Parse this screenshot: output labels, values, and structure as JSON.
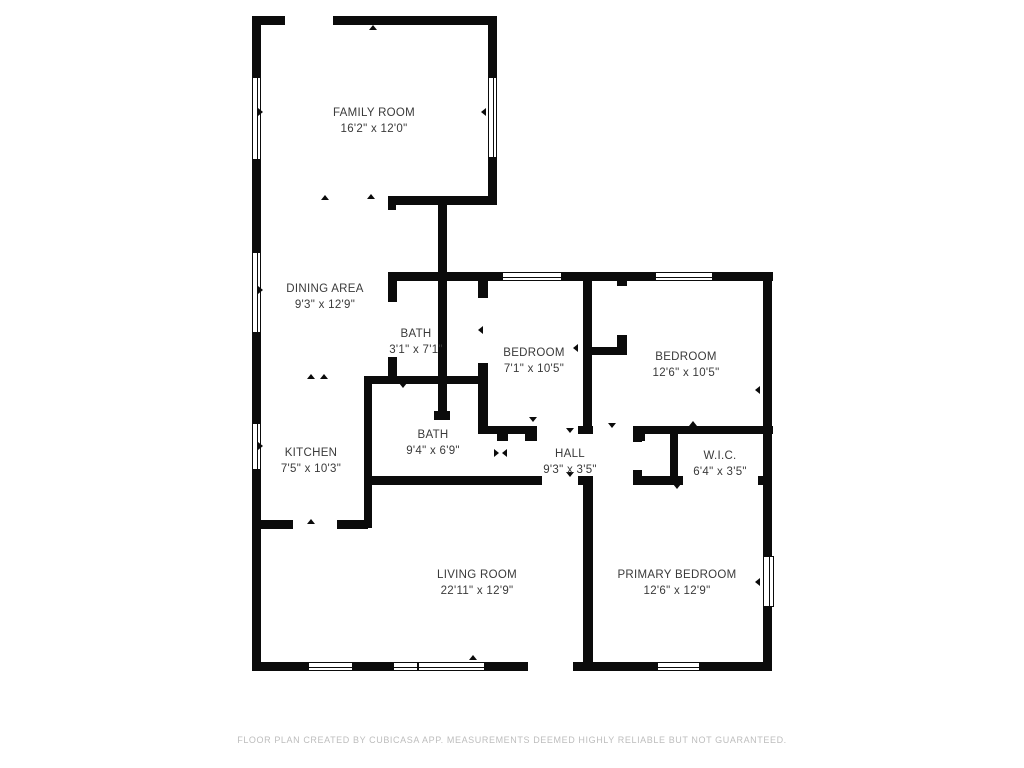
{
  "footer": {
    "text": "FLOOR PLAN CREATED BY CUBICASA APP. MEASUREMENTS DEEMED HIGHLY RELIABLE BUT NOT GUARANTEED."
  },
  "colors": {
    "wall": "#0b0b0b",
    "label": "#3a3a3a",
    "footer": "#bdbdbd",
    "background": "#ffffff"
  },
  "rooms": [
    {
      "name": "FAMILY ROOM",
      "dims": "16'2\" x 12'0\"",
      "cx": 374,
      "cy": 113
    },
    {
      "name": "DINING AREA",
      "dims": "9'3\" x 12'9\"",
      "cx": 325,
      "cy": 289
    },
    {
      "name": "BATH",
      "dims": "3'1\" x 7'1\"",
      "cx": 416,
      "cy": 334
    },
    {
      "name": "BEDROOM",
      "dims": "7'1\" x 10'5\"",
      "cx": 534,
      "cy": 353
    },
    {
      "name": "BEDROOM",
      "dims": "12'6\" x 10'5\"",
      "cx": 686,
      "cy": 357
    },
    {
      "name": "KITCHEN",
      "dims": "7'5\" x 10'3\"",
      "cx": 311,
      "cy": 453
    },
    {
      "name": "BATH",
      "dims": "9'4\" x 6'9\"",
      "cx": 433,
      "cy": 435
    },
    {
      "name": "HALL",
      "dims": "9'3\" x 3'5\"",
      "cx": 570,
      "cy": 454
    },
    {
      "name": "W.I.C.",
      "dims": "6'4\" x 3'5\"",
      "cx": 720,
      "cy": 456
    },
    {
      "name": "LIVING ROOM",
      "dims": "22'11\" x 12'9\"",
      "cx": 477,
      "cy": 575
    },
    {
      "name": "PRIMARY BEDROOM",
      "dims": "12'6\" x 12'9\"",
      "cx": 677,
      "cy": 575
    }
  ],
  "floorplan": {
    "walls": [
      [
        252,
        16,
        33,
        9
      ],
      [
        333,
        16,
        164,
        9
      ],
      [
        388,
        196,
        109,
        9
      ],
      [
        388,
        196,
        8,
        14
      ],
      [
        388,
        272,
        114,
        9
      ],
      [
        562,
        272,
        93,
        9
      ],
      [
        713,
        272,
        60,
        9
      ],
      [
        364,
        376,
        116,
        8
      ],
      [
        592,
        347,
        35,
        8
      ],
      [
        478,
        426,
        59,
        8
      ],
      [
        578,
        426,
        15,
        8
      ],
      [
        633,
        426,
        140,
        8
      ],
      [
        497,
        434,
        11,
        7
      ],
      [
        525,
        434,
        12,
        7
      ],
      [
        634,
        434,
        11,
        7
      ],
      [
        364,
        476,
        178,
        9
      ],
      [
        578,
        476,
        15,
        9
      ],
      [
        633,
        476,
        50,
        9
      ],
      [
        758,
        476,
        14,
        9
      ],
      [
        256,
        520,
        37,
        9
      ],
      [
        337,
        520,
        31,
        9
      ],
      [
        252,
        662,
        56,
        9
      ],
      [
        353,
        662,
        40,
        9
      ],
      [
        485,
        662,
        43,
        9
      ],
      [
        573,
        662,
        84,
        9
      ],
      [
        700,
        662,
        72,
        9
      ],
      [
        252,
        16,
        9,
        61
      ],
      [
        252,
        160,
        9,
        92
      ],
      [
        252,
        333,
        9,
        90
      ],
      [
        252,
        470,
        9,
        192
      ],
      [
        488,
        16,
        9,
        61
      ],
      [
        488,
        158,
        9,
        47
      ],
      [
        438,
        196,
        9,
        224
      ],
      [
        434,
        411,
        16,
        9
      ],
      [
        478,
        281,
        10,
        17
      ],
      [
        478,
        363,
        10,
        71
      ],
      [
        388,
        281,
        9,
        21
      ],
      [
        388,
        357,
        9,
        27
      ],
      [
        364,
        376,
        8,
        152
      ],
      [
        583,
        276,
        9,
        158
      ],
      [
        617,
        278,
        10,
        8
      ],
      [
        617,
        335,
        10,
        12
      ],
      [
        583,
        476,
        10,
        195
      ],
      [
        763,
        272,
        9,
        284
      ],
      [
        763,
        607,
        9,
        64
      ],
      [
        633,
        426,
        9,
        16
      ],
      [
        633,
        470,
        9,
        15
      ],
      [
        670,
        430,
        8,
        55
      ]
    ],
    "windows": [
      [
        252,
        77,
        9,
        83
      ],
      [
        252,
        252,
        9,
        81
      ],
      [
        252,
        423,
        9,
        47
      ],
      [
        488,
        77,
        9,
        81
      ],
      [
        763,
        556,
        11,
        51
      ],
      [
        502,
        272,
        60,
        9
      ],
      [
        655,
        272,
        58,
        9
      ],
      [
        308,
        662,
        45,
        9
      ],
      [
        393,
        662,
        25,
        9
      ],
      [
        418,
        662,
        67,
        9
      ],
      [
        657,
        662,
        43,
        9
      ]
    ],
    "markers": [
      [
        373,
        29,
        "up"
      ],
      [
        325,
        199,
        "up"
      ],
      [
        371,
        198,
        "up"
      ],
      [
        262,
        112,
        "right"
      ],
      [
        485,
        112,
        "left"
      ],
      [
        262,
        290,
        "right"
      ],
      [
        311,
        378,
        "up"
      ],
      [
        324,
        378,
        "up"
      ],
      [
        262,
        446,
        "right"
      ],
      [
        403,
        387,
        "down"
      ],
      [
        482,
        330,
        "left"
      ],
      [
        577,
        348,
        "left"
      ],
      [
        533,
        421,
        "down"
      ],
      [
        570,
        432,
        "down"
      ],
      [
        612,
        427,
        "down"
      ],
      [
        693,
        425,
        "up"
      ],
      [
        759,
        390,
        "left"
      ],
      [
        498,
        453,
        "right"
      ],
      [
        506,
        453,
        "left"
      ],
      [
        677,
        488,
        "down"
      ],
      [
        570,
        476,
        "down"
      ],
      [
        311,
        523,
        "up"
      ],
      [
        473,
        659,
        "up"
      ],
      [
        759,
        582,
        "left"
      ],
      [
        587,
        592,
        "left"
      ]
    ]
  }
}
